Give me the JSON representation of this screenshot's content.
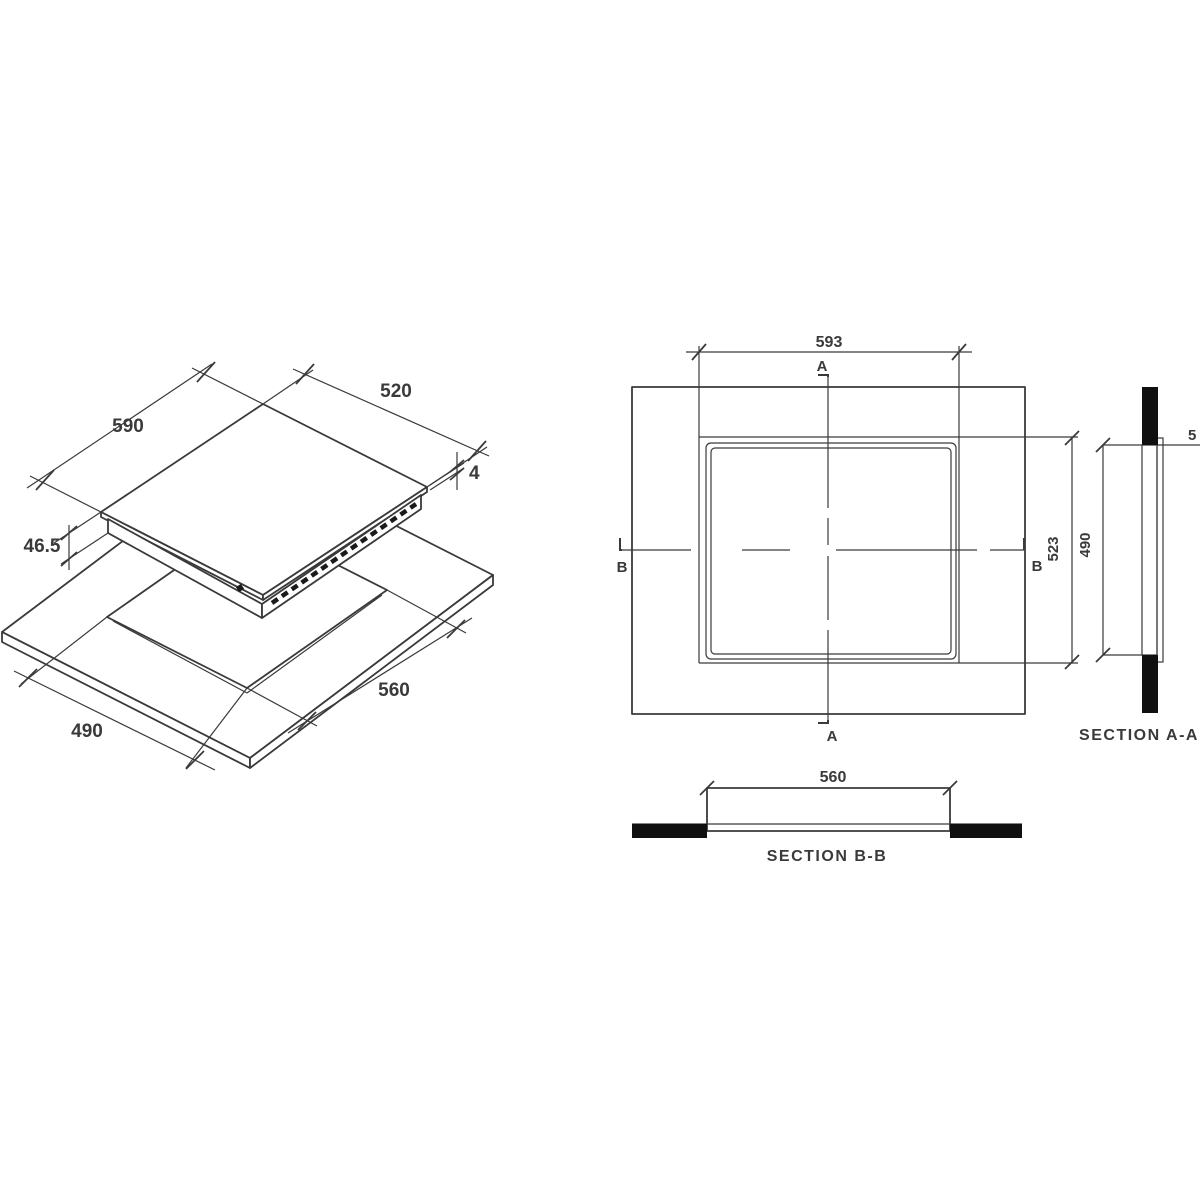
{
  "title": "Built-in hob installation drawing",
  "colors": {
    "line": "#3a3a3a",
    "background": "#ffffff",
    "section_fill": "#101010"
  },
  "iso_view": {
    "glass_width": "590",
    "glass_depth": "520",
    "glass_thickness": "4",
    "body_depth": "46.5",
    "cutout_width": "560",
    "cutout_depth": "490"
  },
  "plan_view": {
    "overall_width": "593",
    "overall_depth": "523",
    "section_a": "A",
    "section_b": "B"
  },
  "section_aa": {
    "title": "SECTION A-A",
    "cutout_depth": "490",
    "clipped_dim": "5"
  },
  "section_bb": {
    "title": "SECTION B-B",
    "cutout_width": "560"
  }
}
